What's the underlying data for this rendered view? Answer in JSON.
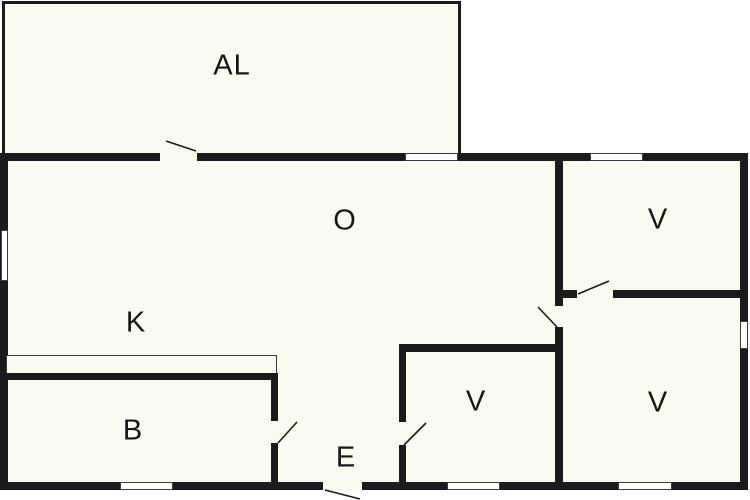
{
  "title": "Floor plan",
  "colors": {
    "wall": "#1b1b1b",
    "interior": "#FBFAF1",
    "background": "#ffffff",
    "outline": "#3c3c3c",
    "label": "#161616"
  },
  "rooms": {
    "al": {
      "label": "AL"
    },
    "o": {
      "label": "O"
    },
    "v_top_right": {
      "label": "V"
    },
    "k": {
      "label": "K"
    },
    "b": {
      "label": "B"
    },
    "e": {
      "label": "E"
    },
    "v_middle": {
      "label": "V"
    },
    "v_bottom_right": {
      "label": "V"
    }
  }
}
